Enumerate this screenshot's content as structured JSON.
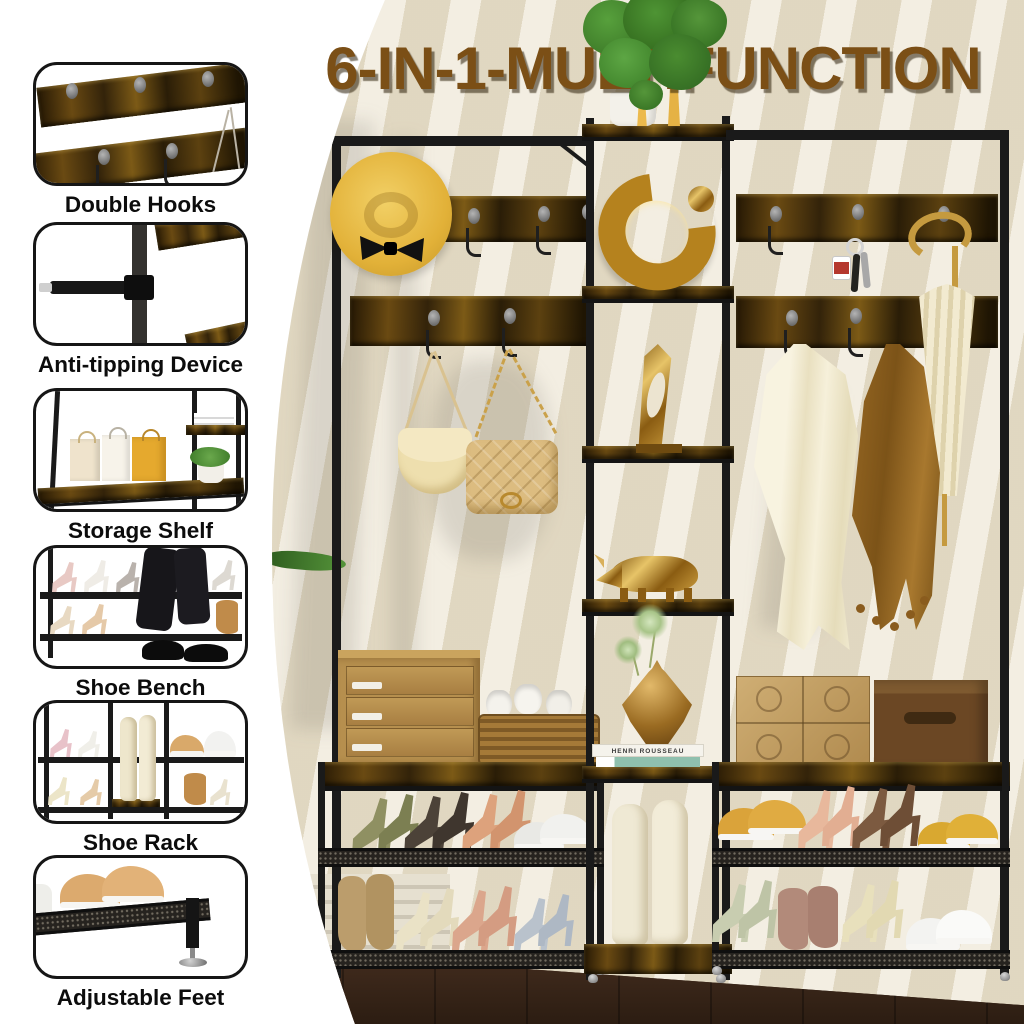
{
  "title": "6-IN-1-MULTIFUNCTION",
  "sidebar": {
    "items": [
      {
        "label": "Double Hooks"
      },
      {
        "label": "Anti-tipping Device"
      },
      {
        "label": "Storage Shelf"
      },
      {
        "label": "Shoe Bench"
      },
      {
        "label": "Shoe Rack"
      },
      {
        "label": "Adjustable Feet"
      }
    ]
  },
  "scene": {
    "book_spine_text": "HENRI ROUSSEAU"
  },
  "colors": {
    "title_brown": "#7b4f16",
    "label_black": "#0c0c0c",
    "frame_black": "#1a1a1a",
    "rustic_wood": "#5f4413",
    "wall_beige": "#ece4d0",
    "floor_brown": "#3a2418"
  }
}
